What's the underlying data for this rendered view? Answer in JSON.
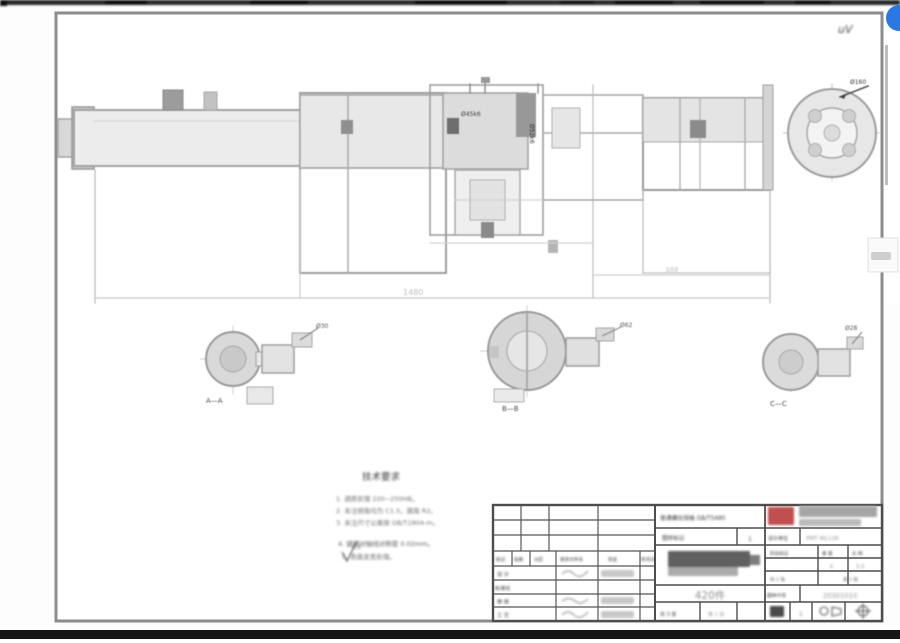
{
  "viewer": {
    "watermark": "uV",
    "fab_color": "#2a78e4",
    "top_bar_color": "#232323",
    "bottom_bar_color": "#161616"
  },
  "drawing": {
    "overall_dim": "1480",
    "mid_dim": "388",
    "callout_left": "Ø45k6",
    "callout_mid": "Ø52k6",
    "callout_end": "Ø160",
    "details": [
      {
        "leader": "Ø30",
        "label": "A—A"
      },
      {
        "leader": "Ø62",
        "label": "B—B"
      },
      {
        "leader": "Ø28",
        "label": "C—C"
      }
    ],
    "notes": {
      "title": "技术要求",
      "line1": "1. 调质处理 220~250HB。",
      "line2": "2. 未注倒角均为 C1.5，圆角 R2。",
      "line3": "3. 未注尺寸公差按 GB/T1804-m。",
      "line4": "4. 键槽对轴线对称度 0.02mm。",
      "line5": "5. 表面发黑处理。",
      "finish": "6.3"
    }
  },
  "title_block": {
    "standard_label": "普通螺纹规格 GB/T5480",
    "mark_label": "图样标记",
    "mark_value": "1",
    "unit_label": "设计单位",
    "unit_value": "PMT WL126",
    "rev_headers": {
      "h1": "标记",
      "h2": "处数",
      "h3": "分区",
      "h4": "更改文件号",
      "h5": "签名",
      "h6": "年月日"
    },
    "rows": {
      "r1": "设 计",
      "r2": "标准化",
      "r3": "审 核",
      "r4": "工 艺"
    },
    "stage_label": "阶段标记",
    "weight_label": "重 量",
    "scale_label": "比 例",
    "weight_value": "6",
    "scale_value": "1:1",
    "sheet_info": "共 1 张",
    "page_info": "第 1 张",
    "qty_text": "420件",
    "bottom_left_a": "共 3 张",
    "bottom_left_b": "第 1 张",
    "code_label": "图样代号",
    "code_value": "20301010",
    "rev_cell": "1"
  }
}
